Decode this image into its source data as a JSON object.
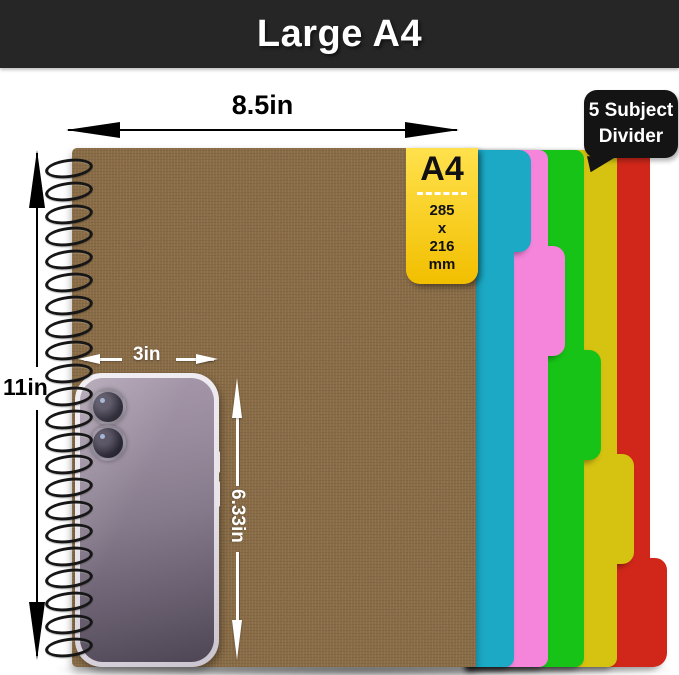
{
  "header": {
    "title": "Large A4"
  },
  "dimensions": {
    "page_width": "8.5in",
    "page_height": "11in",
    "phone_width": "3in",
    "phone_height": "6.33in"
  },
  "badge": {
    "size_label": "A4",
    "height_mm": "285",
    "separator": "x",
    "width_mm": "216",
    "unit": "mm"
  },
  "callout": {
    "line1": "5 Subject",
    "line2": "Divider"
  },
  "dividers": [
    {
      "name": "cyan",
      "color": "#1ba9c5"
    },
    {
      "name": "pink",
      "color": "#f584db"
    },
    {
      "name": "green",
      "color": "#17c317"
    },
    {
      "name": "yellow",
      "color": "#d5c211"
    },
    {
      "name": "red",
      "color": "#d0271a"
    }
  ],
  "notebook": {
    "cover_color": "#8a6a41",
    "spiral_color": "#161616"
  },
  "phone": {
    "case_color": "#e8e4ec",
    "body_gradient_top": "#a89aac",
    "body_gradient_bottom": "#4e4654"
  },
  "colors": {
    "header_bg": "#262626",
    "header_text": "#ffffff",
    "badge_top": "#ffe14d",
    "badge_bottom": "#f2bf00",
    "callout_bg": "#141414"
  }
}
